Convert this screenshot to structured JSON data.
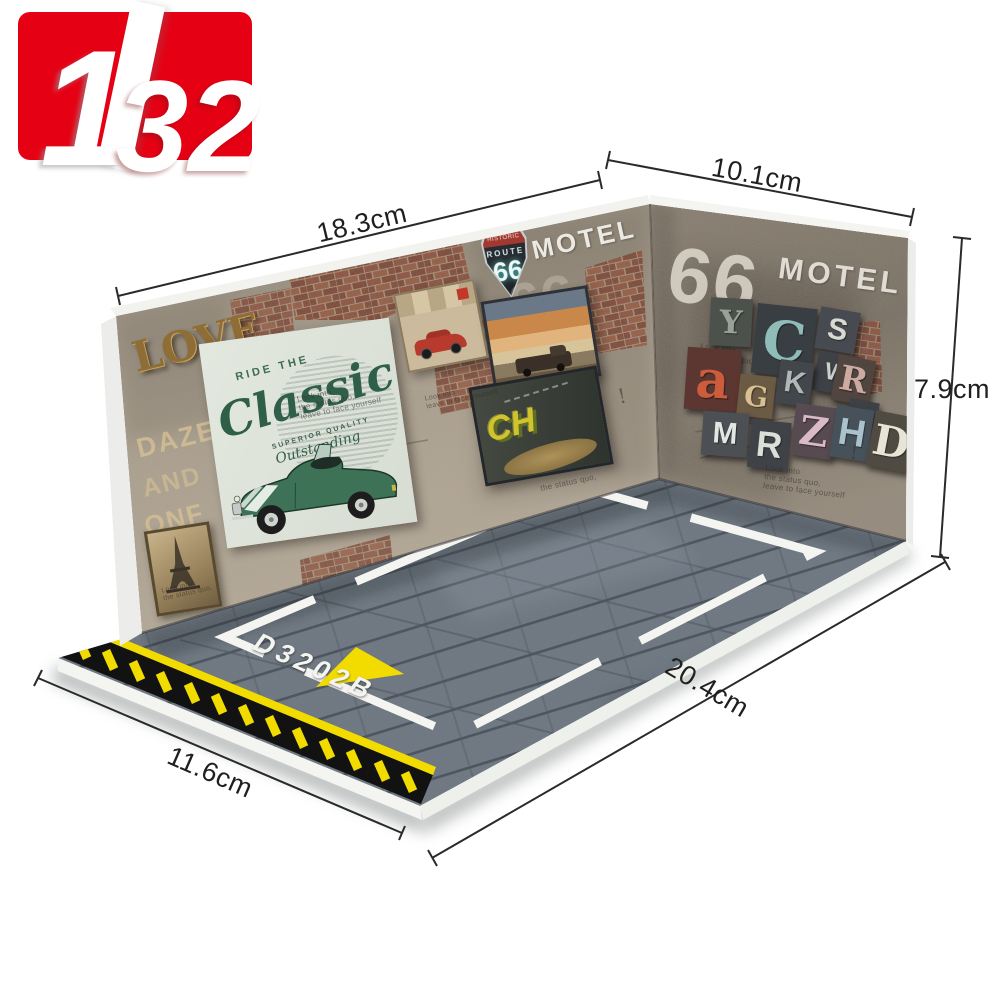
{
  "logo": {
    "scale_top": "1",
    "scale_bottom": "32"
  },
  "dimensions": {
    "left_wall": "18.3cm",
    "right_wall": "10.1cm",
    "height": "7.9cm",
    "floor_front": "20.4cm",
    "floor_side": "11.6cm"
  },
  "left_wall": {
    "love": "LOVE",
    "stencil_1": "DAZE",
    "stencil_2": "AND",
    "stencil_3": "ONF",
    "shield_historic": "HISTORIC",
    "shield_route": "ROUTE",
    "shield_66": "66",
    "motel": "MOTEL",
    "faded_66": "66",
    "poster_ride_the": "RIDE THE",
    "poster_classic": "Classic",
    "poster_superior": "SUPERIOR QUALITY",
    "poster_outstanding": "Outstanding",
    "graffiti": "CH"
  },
  "right_wall": {
    "big_66": "66",
    "motel": "MOTEL",
    "letters": [
      "Y",
      "C",
      "S",
      "W",
      "a",
      "G",
      "K",
      "R",
      "J",
      "M",
      "R",
      "Z",
      "H",
      "D"
    ]
  },
  "floor": {
    "bay_code": "D3202B"
  },
  "fine_print": {
    "line1": "Look into",
    "line2": "the status quo,",
    "line3": "leave to face yourself",
    "mark": "!"
  },
  "colors": {
    "logo_red": "#e60014",
    "hazard_yellow": "#f2dc00",
    "floor_gray": "#6e7883",
    "parking_white": "#f4f4f0"
  }
}
